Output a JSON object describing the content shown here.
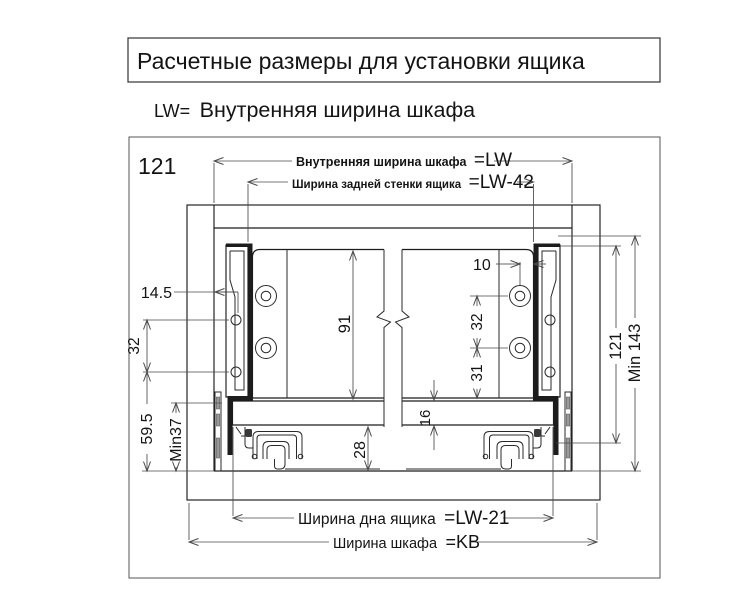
{
  "page": {
    "background": "#ffffff",
    "ink": "#1c1c1c",
    "dim_ink": "#4a4a4a"
  },
  "header": {
    "title": "Расчетные размеры для установки ящика"
  },
  "subtitle": {
    "abbr": "LW=",
    "text": "Внутренняя ширина шкафа"
  },
  "drawing": {
    "corner_label": "121",
    "dimensions": {
      "inner_width_label": "Внутренняя ширина шкафа",
      "inner_width_value": "=LW",
      "back_panel_label": "Ширина задней стенки ящика",
      "back_panel_value": "=LW-42",
      "bottom_panel_label": "Ширина дна ящика",
      "bottom_panel_value": "=LW-21",
      "cabinet_width_label": "Ширина шкафа",
      "cabinet_width_value": "=KB",
      "hole_offset_from_wall": "14.5",
      "hole_spacing_left": "32",
      "lower_hole_height": "59.5",
      "min_bottom_clearance": "Min37",
      "back_panel_height": "91",
      "under_bottom_clearance": "28",
      "hole_offset_from_side": "10",
      "hole_spacing_right": "32",
      "lower_hole_to_bottom": "31",
      "bottom_panel_thickness": "16",
      "side_height": "121",
      "min_inner_height": "Min 143"
    }
  }
}
